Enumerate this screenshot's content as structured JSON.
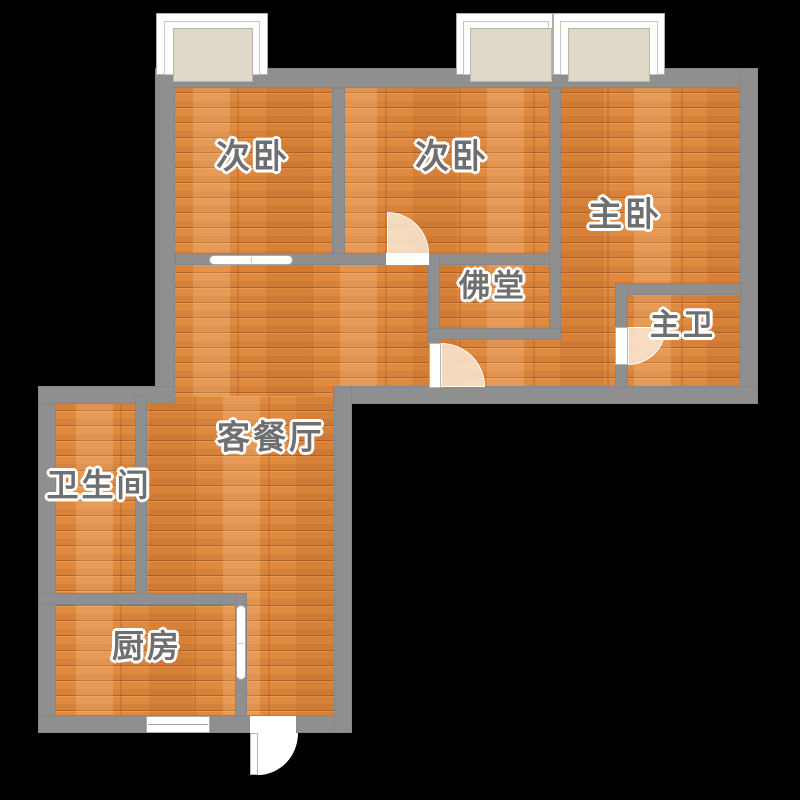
{
  "canvas": {
    "width": 800,
    "height": 800,
    "background": "#000000"
  },
  "palette": {
    "wall": "#8F8F8F",
    "floor_base": "#E08A40",
    "floor_plank_light": "#ECA46A",
    "floor_plank_dark": "#D67B2F",
    "window_glass": "#DFD9CA",
    "door_swing": "rgba(250,233,212,0.85)",
    "entry_swing_fill": "#FFFFFF",
    "label_color": "#6F6F6F",
    "label_halo": "#FFFFFF"
  },
  "rooms": [
    {
      "id": "bedroom-second-left",
      "label": "次卧",
      "cx": 253,
      "cy": 157,
      "size": 34
    },
    {
      "id": "bedroom-second-mid",
      "label": "次卧",
      "cx": 452,
      "cy": 157,
      "size": 34
    },
    {
      "id": "master-bedroom",
      "label": "主卧",
      "cx": 625,
      "cy": 215,
      "size": 34
    },
    {
      "id": "buddhist-hall",
      "label": "佛堂",
      "cx": 493,
      "cy": 286,
      "size": 31
    },
    {
      "id": "master-bathroom",
      "label": "主卫",
      "cx": 683,
      "cy": 326,
      "size": 30
    },
    {
      "id": "living-dining-room",
      "label": "客餐厅",
      "cx": 271,
      "cy": 437,
      "size": 33
    },
    {
      "id": "bathroom",
      "label": "卫生间",
      "cx": 99,
      "cy": 485,
      "size": 32
    },
    {
      "id": "kitchen",
      "label": "厨房",
      "cx": 147,
      "cy": 646,
      "size": 32
    }
  ],
  "floors": [
    {
      "x": 163,
      "y": 78,
      "w": 589,
      "h": 320
    },
    {
      "x": 46,
      "y": 396,
      "w": 296,
      "h": 330
    }
  ],
  "walls": [
    {
      "x": 155,
      "y": 68,
      "w": 603,
      "h": 20
    },
    {
      "x": 155,
      "y": 68,
      "w": 20,
      "h": 336
    },
    {
      "x": 740,
      "y": 68,
      "w": 18,
      "h": 336
    },
    {
      "x": 333,
      "y": 386,
      "w": 425,
      "h": 18
    },
    {
      "x": 38,
      "y": 386,
      "w": 18,
      "h": 347
    },
    {
      "x": 38,
      "y": 386,
      "w": 137,
      "h": 18
    },
    {
      "x": 38,
      "y": 715,
      "w": 314,
      "h": 18
    },
    {
      "x": 334,
      "y": 386,
      "w": 18,
      "h": 347
    },
    {
      "x": 332,
      "y": 88,
      "w": 13,
      "h": 166
    },
    {
      "x": 175,
      "y": 253,
      "w": 385,
      "h": 12
    },
    {
      "x": 549,
      "y": 88,
      "w": 12,
      "h": 252
    },
    {
      "x": 428,
      "y": 253,
      "w": 12,
      "h": 92
    },
    {
      "x": 428,
      "y": 328,
      "w": 133,
      "h": 12
    },
    {
      "x": 615,
      "y": 283,
      "w": 127,
      "h": 12
    },
    {
      "x": 615,
      "y": 283,
      "w": 13,
      "h": 105
    },
    {
      "x": 135,
      "y": 396,
      "w": 12,
      "h": 201
    },
    {
      "x": 38,
      "y": 593,
      "w": 209,
      "h": 12
    },
    {
      "x": 235,
      "y": 593,
      "w": 12,
      "h": 124
    }
  ],
  "windows": [
    {
      "name": "window-bedroom-left",
      "frame": {
        "x": 156,
        "y": 13,
        "w": 112,
        "h": 62
      },
      "inner": {
        "x": 164,
        "y": 21,
        "w": 96,
        "h": 54
      },
      "glass": {
        "x": 173,
        "y": 28,
        "w": 80,
        "h": 54
      }
    },
    {
      "name": "window-bedroom-mid",
      "frame": {
        "x": 456,
        "y": 13,
        "w": 97,
        "h": 62
      },
      "inner": {
        "x": 463,
        "y": 21,
        "w": 86,
        "h": 54
      },
      "glass": {
        "x": 470,
        "y": 28,
        "w": 82,
        "h": 54
      }
    },
    {
      "name": "window-master-bedroom",
      "frame": {
        "x": 553,
        "y": 13,
        "w": 112,
        "h": 62
      },
      "inner": {
        "x": 560,
        "y": 21,
        "w": 98,
        "h": 54
      },
      "glass": {
        "x": 568,
        "y": 28,
        "w": 82,
        "h": 54
      }
    },
    {
      "name": "window-kitchen",
      "frame": {
        "x": 146,
        "y": 716,
        "w": 64,
        "h": 17
      },
      "mullion": true
    }
  ],
  "doors": [
    {
      "type": "sliding",
      "name": "door-bedroom-left-sliding",
      "rect": {
        "x": 209,
        "y": 255,
        "w": 84,
        "h": 10
      },
      "orient": "h"
    },
    {
      "type": "swing",
      "name": "door-bedroom-mid",
      "threshold": {
        "x": 386,
        "y": 253,
        "w": 43,
        "h": 12
      },
      "swing": {
        "x": 387,
        "y": 212,
        "w": 42,
        "h": 42
      },
      "corner": "top-right"
    },
    {
      "type": "swing",
      "name": "door-hallway",
      "leaf": {
        "x": 429,
        "y": 343,
        "w": 12,
        "h": 45
      },
      "swing": {
        "x": 441,
        "y": 343,
        "w": 44,
        "h": 44
      },
      "corner": "top-right"
    },
    {
      "type": "swing",
      "name": "door-master-bath",
      "leaf": {
        "x": 615,
        "y": 327,
        "w": 13,
        "h": 38
      },
      "swing": {
        "x": 628,
        "y": 327,
        "w": 38,
        "h": 38
      },
      "corner": "bottom-right"
    },
    {
      "type": "sliding",
      "name": "door-kitchen-sliding",
      "rect": {
        "x": 236,
        "y": 605,
        "w": 10,
        "h": 75
      },
      "orient": "v"
    },
    {
      "type": "swing",
      "name": "door-entry",
      "threshold": {
        "x": 250,
        "y": 716,
        "w": 46,
        "h": 17
      },
      "leaf": {
        "x": 250,
        "y": 733,
        "w": 8,
        "h": 42
      },
      "swing": {
        "x": 258,
        "y": 733,
        "w": 40,
        "h": 42
      },
      "corner": "bottom-right",
      "fill": "#FFFFFF"
    }
  ]
}
